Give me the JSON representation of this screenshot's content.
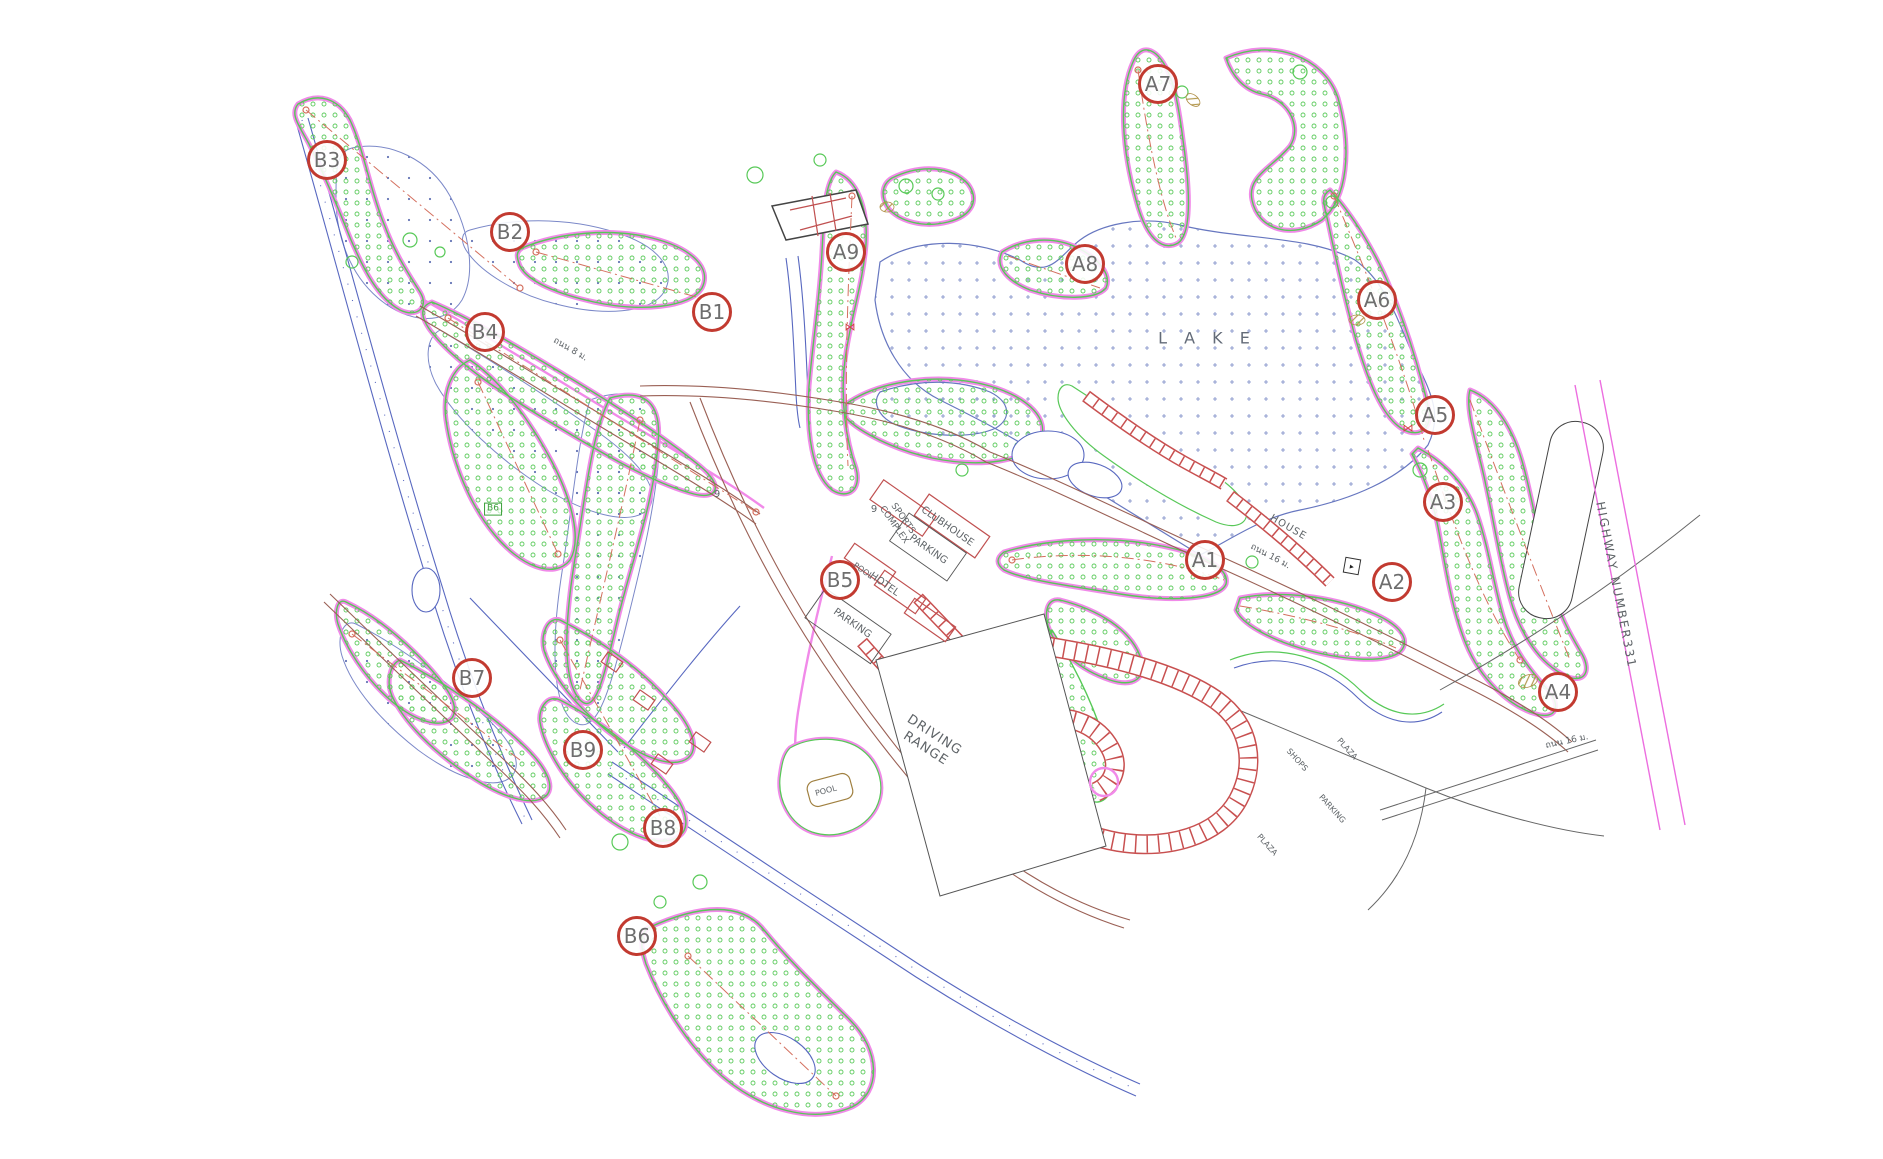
{
  "plan_title": "Golf course master plan drawing",
  "colors": {
    "cart_path_magenta": "#f18ae9",
    "fairway_green": "#57c957",
    "lake_blue": "#6777c0",
    "road_brown": "#9a6055",
    "house_red": "#c85050",
    "marker_ring_red": "#c23a30",
    "marker_text_gray": "#6e6e6e",
    "centerline_red": "#d4705f",
    "highway_magenta": "#ec6ee0",
    "label_gray": "#5f6468",
    "tee_label_green": "#3aa03a"
  },
  "hole_markers": [
    {
      "label": "A1",
      "x": 1205,
      "y": 560
    },
    {
      "label": "A2",
      "x": 1392,
      "y": 582
    },
    {
      "label": "A3",
      "x": 1443,
      "y": 502
    },
    {
      "label": "A4",
      "x": 1558,
      "y": 692
    },
    {
      "label": "A5",
      "x": 1435,
      "y": 415
    },
    {
      "label": "A6",
      "x": 1377,
      "y": 300
    },
    {
      "label": "A7",
      "x": 1158,
      "y": 84
    },
    {
      "label": "A8",
      "x": 1085,
      "y": 264
    },
    {
      "label": "A9",
      "x": 846,
      "y": 252
    },
    {
      "label": "B1",
      "x": 712,
      "y": 312
    },
    {
      "label": "B2",
      "x": 510,
      "y": 232
    },
    {
      "label": "B3",
      "x": 327,
      "y": 160
    },
    {
      "label": "B4",
      "x": 485,
      "y": 332
    },
    {
      "label": "B5",
      "x": 840,
      "y": 580
    },
    {
      "label": "B6",
      "x": 637,
      "y": 936
    },
    {
      "label": "B7",
      "x": 472,
      "y": 678
    },
    {
      "label": "B8",
      "x": 663,
      "y": 828
    },
    {
      "label": "B9",
      "x": 583,
      "y": 750
    }
  ],
  "labels": [
    {
      "id": "lake",
      "text": "L A K E",
      "x": 1207,
      "y": 338,
      "rot": 0,
      "size": 16,
      "spacing": 6,
      "color": "#636b78"
    },
    {
      "id": "house",
      "text": "HOUSE",
      "x": 1288,
      "y": 528,
      "rot": 30,
      "size": 10,
      "spacing": 1
    },
    {
      "id": "road-16m-a",
      "text": "ถนน 16 ม.",
      "x": 1270,
      "y": 557,
      "rot": 28,
      "size": 9
    },
    {
      "id": "road-16m-b",
      "text": "ถนน 16 ม.",
      "x": 1567,
      "y": 742,
      "rot": -12,
      "size": 9
    },
    {
      "id": "road-8m",
      "text": "ถนน 8 ม.",
      "x": 570,
      "y": 350,
      "rot": 30,
      "size": 9
    },
    {
      "id": "sports-complex",
      "text": "SPORTS\nCOMPLEX",
      "x": 898,
      "y": 522,
      "rot": 55,
      "size": 9
    },
    {
      "id": "clubhouse",
      "text": "CLUBHOUSE",
      "x": 947,
      "y": 527,
      "rot": 35,
      "size": 10
    },
    {
      "id": "parking-club",
      "text": "PARKING",
      "x": 928,
      "y": 550,
      "rot": 35,
      "size": 10
    },
    {
      "id": "pool-hotel",
      "text": "POOL",
      "x": 863,
      "y": 571,
      "rot": 35,
      "size": 8
    },
    {
      "id": "hotel",
      "text": "HOTEL",
      "x": 884,
      "y": 585,
      "rot": 35,
      "size": 10
    },
    {
      "id": "parking-hotel",
      "text": "PARKING",
      "x": 852,
      "y": 624,
      "rot": 35,
      "size": 10
    },
    {
      "id": "driving-range",
      "text": "DRIVING\nRANGE",
      "x": 930,
      "y": 742,
      "rot": 33,
      "size": 13,
      "spacing": 1
    },
    {
      "id": "pool-main",
      "text": "POOL",
      "x": 826,
      "y": 791,
      "rot": -15,
      "size": 8
    },
    {
      "id": "plaza-1",
      "text": "PLAZA",
      "x": 1347,
      "y": 749,
      "rot": 48,
      "size": 8
    },
    {
      "id": "shops",
      "text": "SHOPS",
      "x": 1297,
      "y": 760,
      "rot": 48,
      "size": 8
    },
    {
      "id": "parking-plaza",
      "text": "PARKING",
      "x": 1332,
      "y": 809,
      "rot": 48,
      "size": 8
    },
    {
      "id": "plaza-2",
      "text": "PLAZA",
      "x": 1267,
      "y": 845,
      "rot": 48,
      "size": 8
    },
    {
      "id": "highway",
      "text": "HIGHWAY NUMBER331",
      "x": 1616,
      "y": 585,
      "rot": 79,
      "size": 12,
      "spacing": 2
    },
    {
      "id": "green-9-a",
      "text": "9",
      "x": 717,
      "y": 495,
      "rot": 0,
      "size": 10
    },
    {
      "id": "green-9-b",
      "text": "9",
      "x": 874,
      "y": 510,
      "rot": 0,
      "size": 10
    },
    {
      "id": "tee-b6",
      "text": "B6",
      "x": 493,
      "y": 509,
      "rot": 0,
      "size": 9,
      "color": "#3aa03a",
      "boxed": true
    }
  ],
  "icons": [
    {
      "name": "sluice-icon",
      "glyph": "⋈",
      "x": 850,
      "y": 327
    },
    {
      "name": "sluice-icon",
      "glyph": "⋈",
      "x": 1408,
      "y": 428
    },
    {
      "name": "pump-station-icon",
      "glyph": "▸",
      "x": 1352,
      "y": 566,
      "boxed": true
    }
  ]
}
